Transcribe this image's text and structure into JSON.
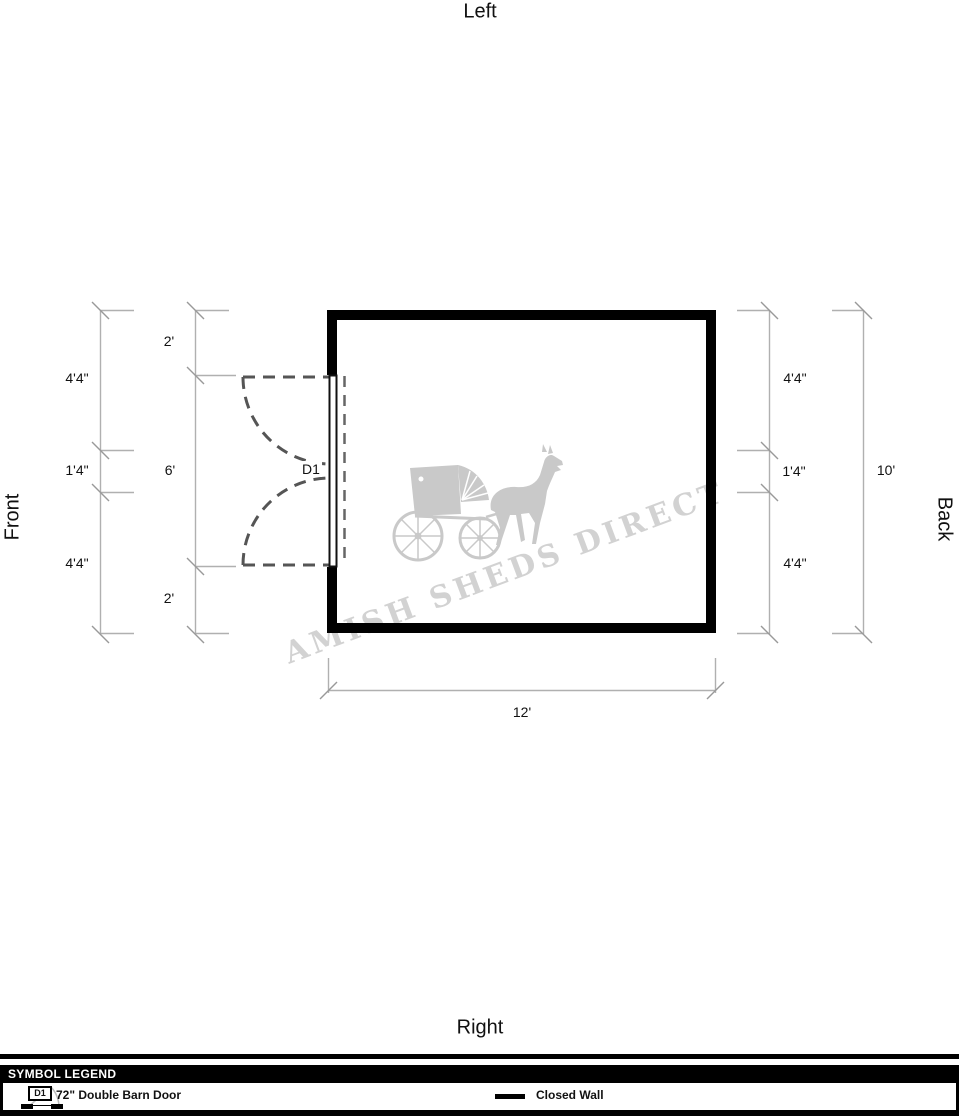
{
  "orientation_labels": {
    "top": "Left",
    "bottom": "Right",
    "left": "Front",
    "right": "Back"
  },
  "floor_plan": {
    "door_label": "D1",
    "shed_width": "12'",
    "shed_depth": "10'",
    "dimensions": {
      "left_outer": {
        "top": "4'4\"",
        "middle": "1'4\"",
        "bottom": "4'4\""
      },
      "left_inner": {
        "top": "2'",
        "middle": "6'",
        "bottom": "2'"
      },
      "right_inner": {
        "top": "4'4\"",
        "middle": "1'4\"",
        "bottom": "4'4\""
      },
      "right_overall": "10'",
      "bottom_overall": "12'"
    }
  },
  "watermark": {
    "text": "AMISH SHEDS DIRECT"
  },
  "legend": {
    "header": "SYMBOL LEGEND",
    "items": [
      {
        "code": "D1",
        "label": "72\" Double Barn Door"
      },
      {
        "label": "Closed Wall"
      }
    ]
  },
  "colors": {
    "wall": "#000000",
    "dimension_line": "#b0b0b0",
    "tick": "#999999",
    "door_dash": "#555555",
    "watermark": "#d2d2d2"
  }
}
